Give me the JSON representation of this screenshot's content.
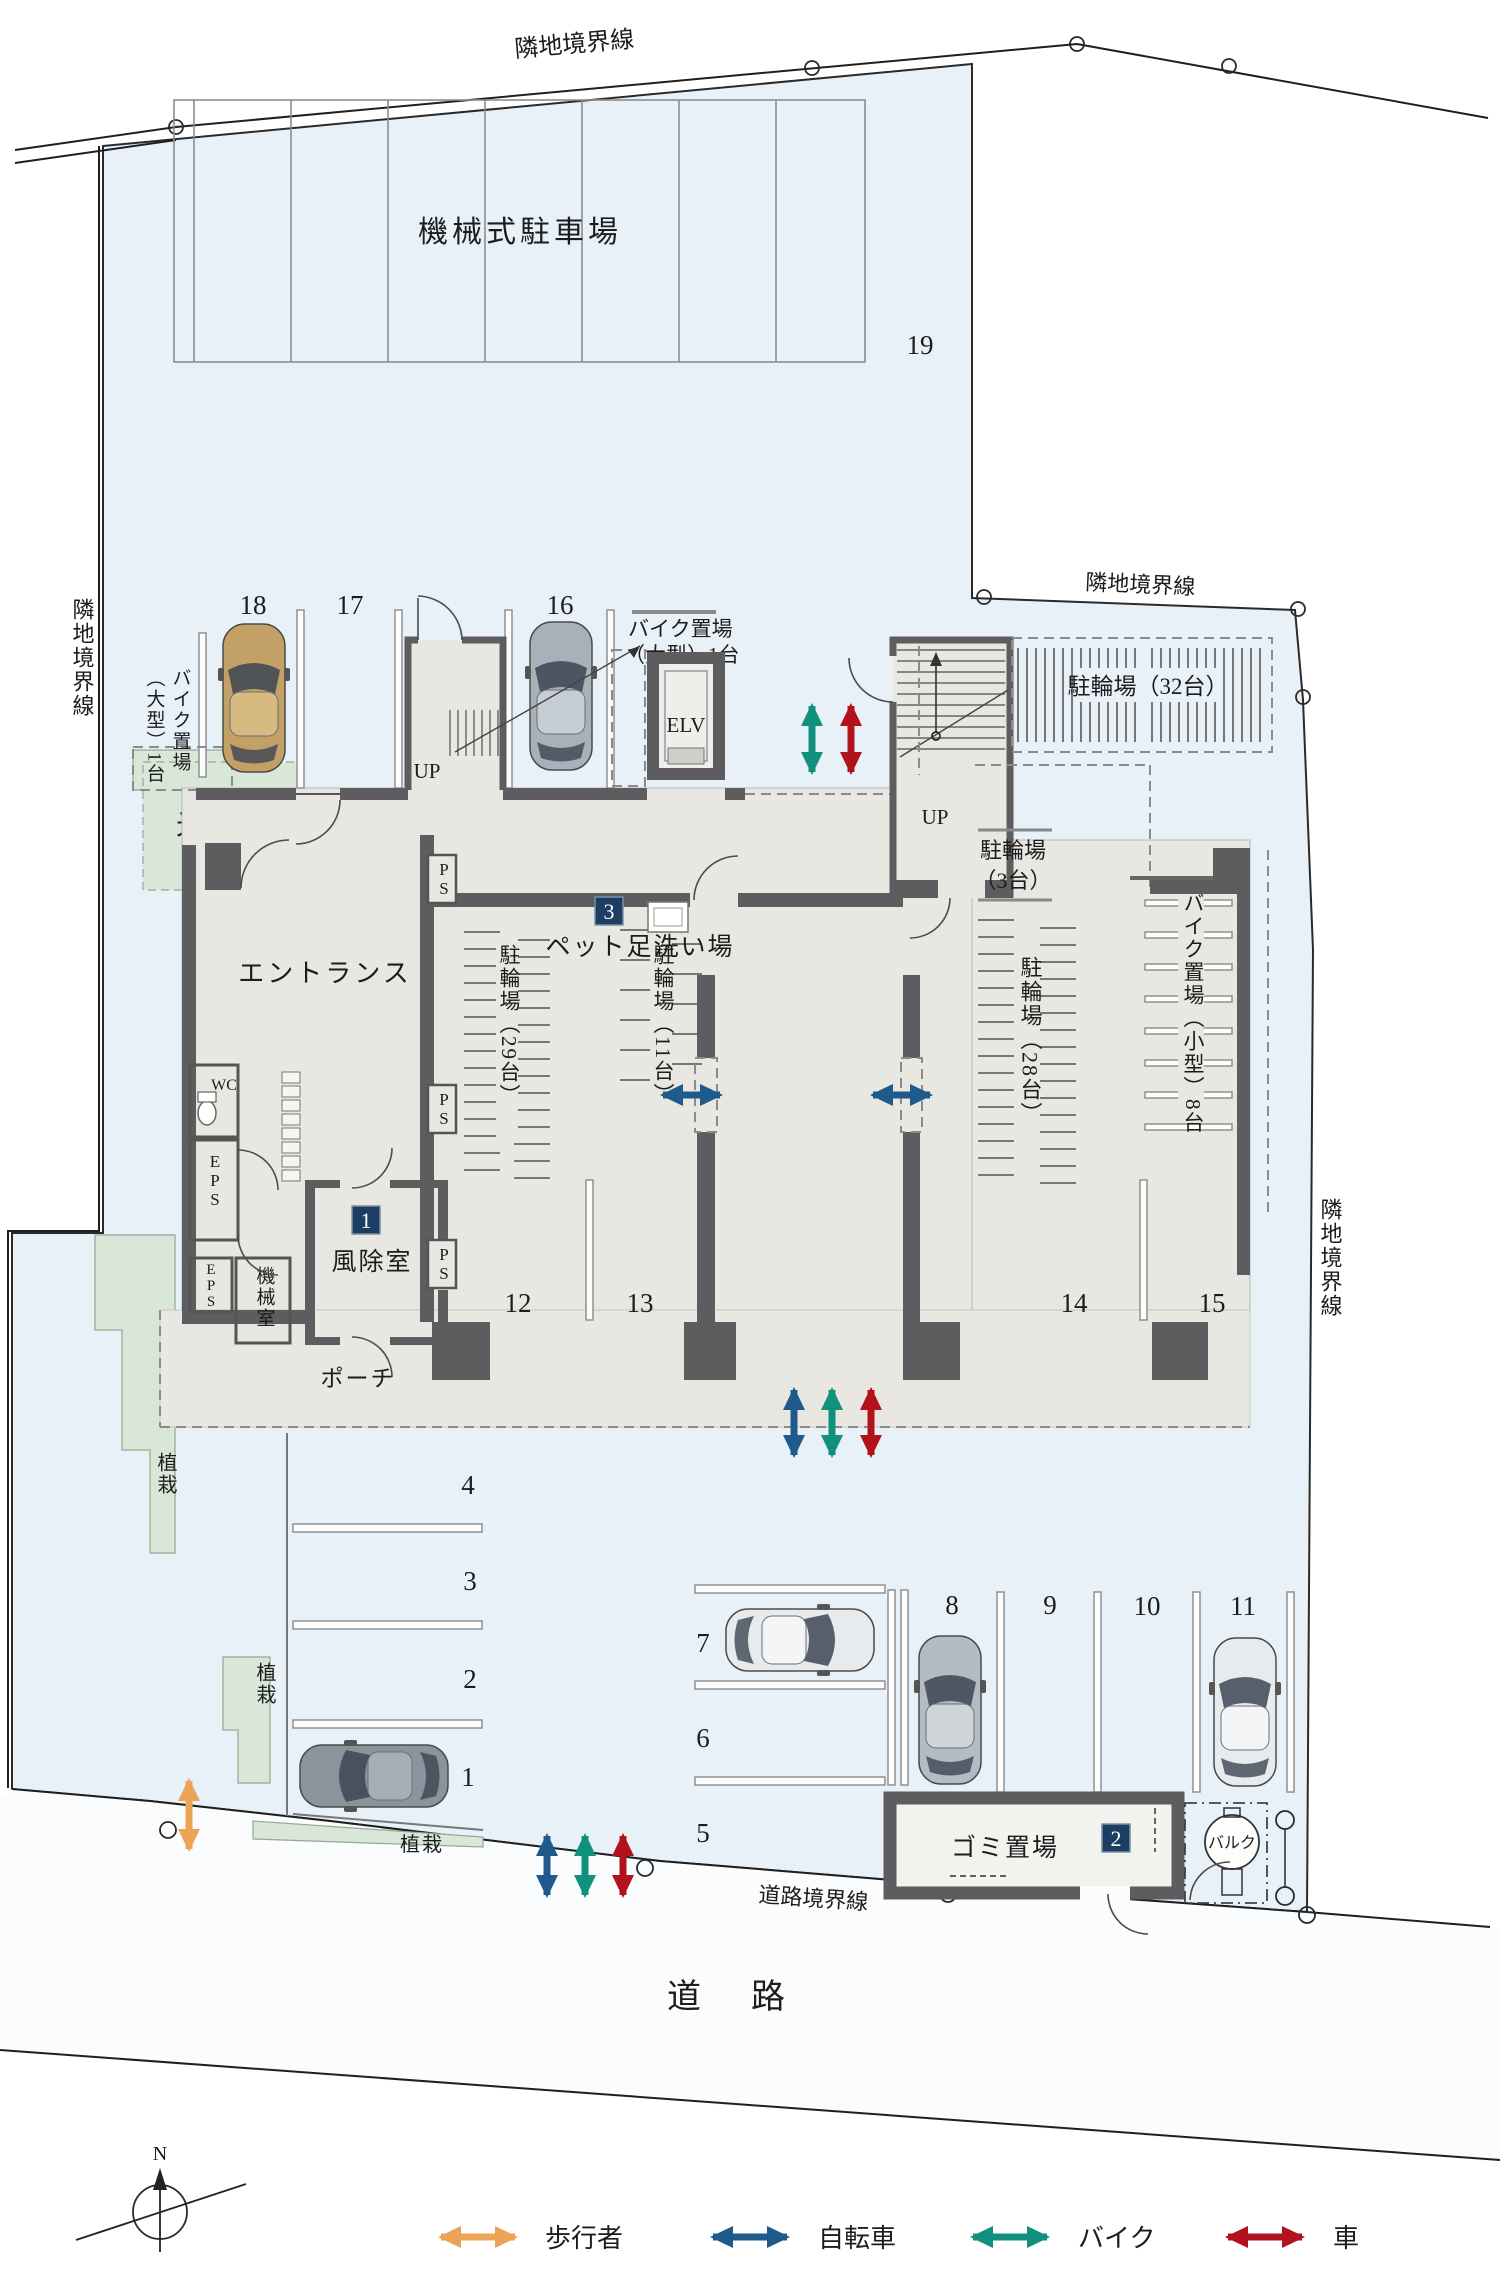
{
  "site": {
    "adjacent_boundary": "隣地境界線",
    "road_boundary": "道路境界線",
    "road": "道　路",
    "north": "N",
    "site_fill": "#e9f1f8",
    "building_fill": "#e9e7e1",
    "wall_color": "#5d5c5f"
  },
  "rooms": {
    "mechanical_parking": "機械式駐車場",
    "light_court": "光庭",
    "entrance": "エントランス",
    "wc": "WC",
    "eps": "EPS",
    "machine_room": "機械室",
    "windbreak": "風除室",
    "porch": "ポーチ",
    "ps": "PS",
    "up": "UP",
    "elv": "ELV",
    "pet_wash": "ペット足洗い場",
    "garbage": "ゴミ置場",
    "bulk": "バルク",
    "planting": "植栽"
  },
  "bike": {
    "rack32": "駐輪場（32台）",
    "rack3_1": "駐輪場",
    "rack3_2": "（3台）",
    "rack29": "駐輪場（29台）",
    "rack11": "駐輪場（11台）",
    "rack28": "駐輪場（28台）",
    "moto_large_1": "バイク置場",
    "moto_large_2": "（大型）1台",
    "moto_small": "バイク置場（小型）8台"
  },
  "stalls": {
    "s1": "1",
    "s2": "2",
    "s3": "3",
    "s4": "4",
    "s5": "5",
    "s6": "6",
    "s7": "7",
    "s8": "8",
    "s9": "9",
    "s10": "10",
    "s11": "11",
    "s12": "12",
    "s13": "13",
    "s14": "14",
    "s15": "15",
    "s16": "16",
    "s17": "17",
    "s18": "18",
    "s19": "19"
  },
  "badges": {
    "b1": "1",
    "b2": "2",
    "b3": "3"
  },
  "legend": [
    {
      "label": "歩行者",
      "color": "#eda356"
    },
    {
      "label": "自転車",
      "color": "#1e5b8c"
    },
    {
      "label": "バイク",
      "color": "#12907e"
    },
    {
      "label": "車",
      "color": "#b2121c"
    }
  ]
}
